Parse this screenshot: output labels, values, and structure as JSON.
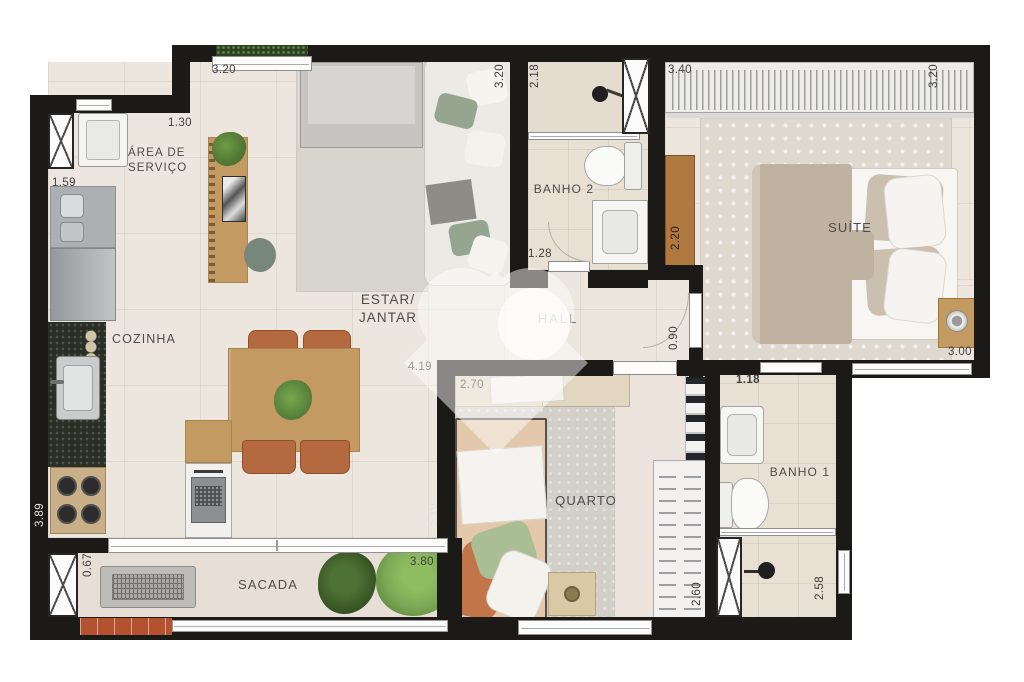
{
  "plan_title": "Apartment floor plan",
  "rooms": {
    "area_servico": "ÁREA DE\nSERVIÇO",
    "cozinha": "COZINHA",
    "estar_jantar": "ESTAR/\nJANTAR",
    "hall": "HALL",
    "banho2": "BANHO 2",
    "suite": "SUÍTE",
    "quarto": "QUARTO",
    "banho1": "BANHO 1",
    "sacada": "SACADA"
  },
  "dims": {
    "estar_top_width": "3.20",
    "servico_width": "1.30",
    "servico_depth": "1.59",
    "estar_right_height": "3.20",
    "banho2_height": "2.18",
    "suite_wardrobe_width": "3.40",
    "suite_height": "3.20",
    "banho2_width": "1.28",
    "suite_cabinet_run": "2.20",
    "hall_passage": "0.90",
    "estar_width": "4.19",
    "quarto_width": "2.70",
    "banho1_width": "1.18",
    "suite_bed_wall": "3.00",
    "estar_full_height": "5.10",
    "cozinha_run": "3.89",
    "sacada_width": "3.80",
    "sacada_depth": "0.67",
    "quarto_closet_run": "2.60",
    "banho1_height": "2.58"
  },
  "colors": {
    "wall": "#1c1a17",
    "floor": "#EDE6DF",
    "floorBath": "#E9E0D4",
    "floorBalcony": "#E7DFD6",
    "wood": "#C49A63",
    "woodDark": "#B0793F",
    "terracotta": "#B4693F",
    "brick": "#B2522F",
    "granite": "#2A2F25",
    "rug": "#D8D4CE",
    "rugSuite": "#DED8CF",
    "rugQuarto": "#D2CFC9",
    "sofa": "#ECEAE4",
    "cushionGreen": "#95A58F",
    "bedTan": "#E4C8AB",
    "blanketSuite": "#C0B2A1",
    "wardrobe": "#EDECEA",
    "plant": "#55803A",
    "plantLight": "#7CA957",
    "appliance": "#ADB0B2",
    "label": "#4c4c4c",
    "dim": "#3f3f3f"
  }
}
